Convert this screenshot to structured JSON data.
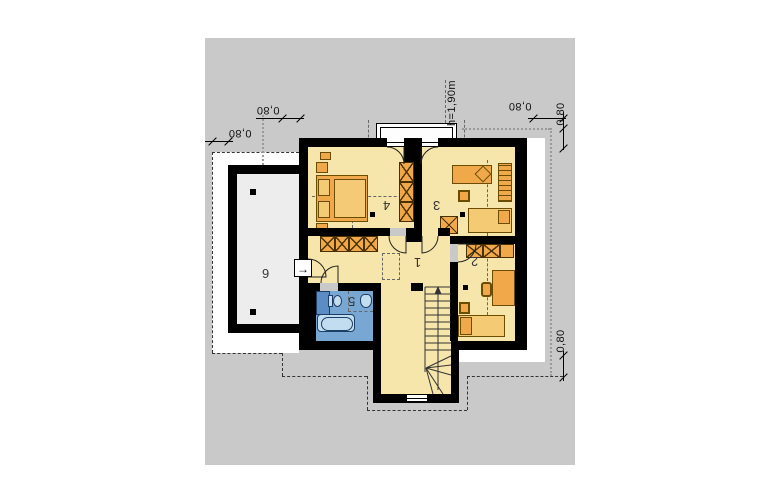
{
  "title": "attic floor plan",
  "rooms": [
    {
      "id": "hall",
      "label": "1"
    },
    {
      "id": "bedroom-right",
      "label": "2"
    },
    {
      "id": "bedroom-top-right",
      "label": "3"
    },
    {
      "id": "bedroom-top-left",
      "label": "4"
    },
    {
      "id": "bathroom",
      "label": "5"
    },
    {
      "id": "storage-annex",
      "label": "6"
    }
  ],
  "dimensions": {
    "outer_left": "0,80",
    "inner_left": "0,80",
    "top_right": "0,80",
    "right_upper": "0,80",
    "right_lower": "0,80",
    "height_note": "h=1,90m"
  },
  "icons": {
    "exit_arrow": "→"
  },
  "colors": {
    "canvas": "#c9c9c9",
    "floor": "#f7e6ab",
    "bath_floor": "#79a7d4",
    "furniture": "#efa94a",
    "wall": "#000000"
  }
}
